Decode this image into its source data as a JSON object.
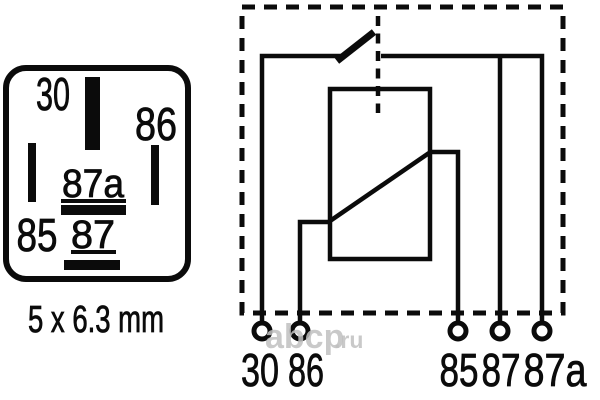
{
  "pinout": {
    "pins": {
      "p30": "30",
      "p86": "86",
      "p85": "85",
      "p87a": "87a",
      "p87": "87"
    },
    "size": "5 x 6.3 mm"
  },
  "schematic": {
    "terminals": {
      "t30": "30",
      "t86": "86",
      "t85": "85",
      "t87": "87",
      "t87a": "87a"
    }
  },
  "watermark": {
    "name": "abcp",
    "tld": ".ru"
  },
  "colors": {
    "ink": "#0b0b0b",
    "background": "#ffffff",
    "watermark": "#c0c0c0"
  }
}
